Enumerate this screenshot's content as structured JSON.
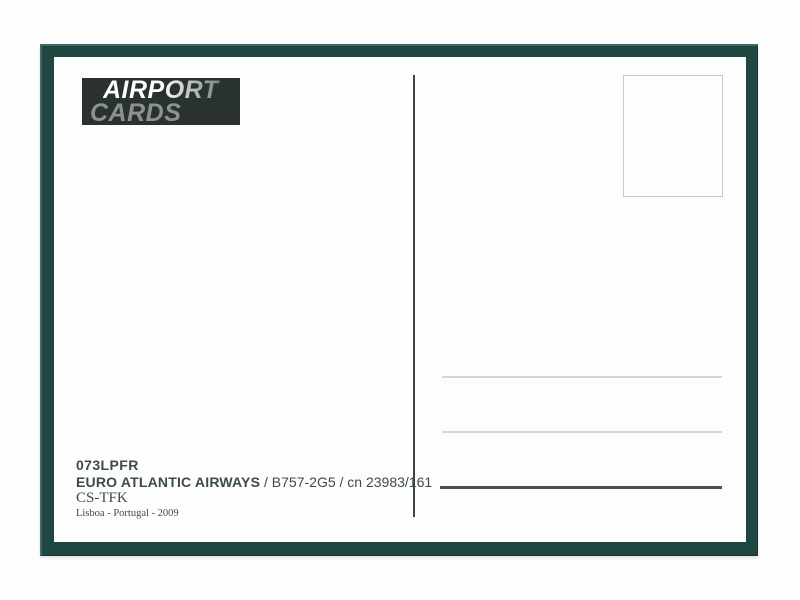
{
  "postcard": {
    "type": "airport-collector-card-back",
    "colors": {
      "page_background": "#fefefe",
      "frame": "#204642",
      "card_face": "#fdfdfd",
      "logo_box": "#2a322f",
      "logo_word1_gradient_start": "#ffffff",
      "logo_word1_gradient_end": "#4e5857",
      "logo_word2": "#8b9291",
      "divider": "#3c4443",
      "stamp_border": "#c9c9c9",
      "address_line_light": "#d6d6d6",
      "address_line_dark": "#47524f",
      "text": "#3d4b4b"
    },
    "logo": {
      "word1": "AIRPORT",
      "word2": "CARDS"
    },
    "details": {
      "card_number": "073LPFR",
      "airline": "EURO ATLANTIC AIRWAYS",
      "aircraft_info": "/ B757-2G5 / cn 23983/161",
      "registration": "CS-TFK",
      "location_year": "Lisboa - Portugal - 2009"
    }
  }
}
